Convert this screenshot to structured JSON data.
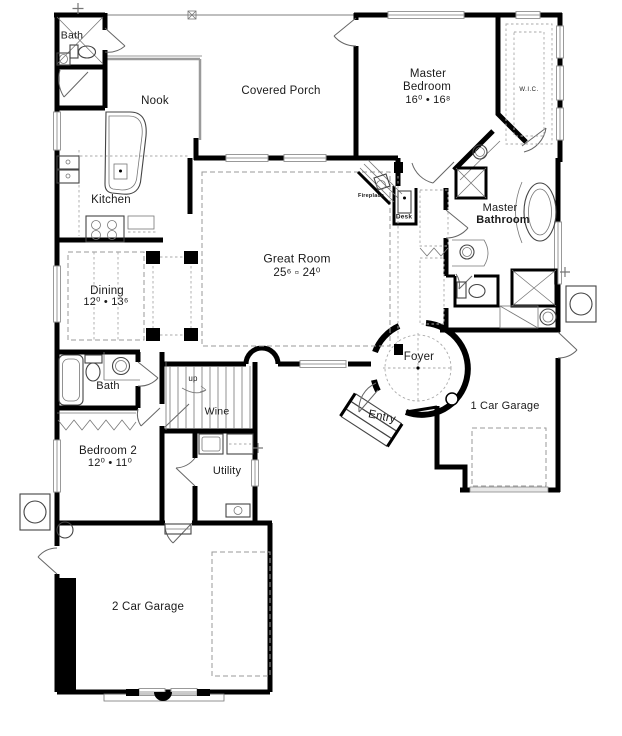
{
  "plan": {
    "rooms": {
      "bath_upper": {
        "label": "Bath"
      },
      "nook": {
        "label": "Nook"
      },
      "covered_porch": {
        "label": "Covered Porch"
      },
      "master_bedroom": {
        "line1": "Master",
        "line2": "Bedroom",
        "dims": "16⁰ •  16⁸"
      },
      "wic": {
        "label": "W.I.C."
      },
      "kitchen": {
        "label": "Kitchen"
      },
      "fireplace": {
        "label": "Fireplace"
      },
      "desk": {
        "label": "Desk"
      },
      "master_bathroom": {
        "line1": "Master",
        "line2": "Bathroom"
      },
      "great_room": {
        "label": "Great Room",
        "dims": "25⁶ ▫ 24⁰"
      },
      "dining": {
        "label": "Dining",
        "dims": "12⁰ •  13⁶"
      },
      "bath_main": {
        "label": "Bath"
      },
      "stairs": {
        "label": "up"
      },
      "wine": {
        "label": "Wine"
      },
      "foyer": {
        "label": "Foyer"
      },
      "entry": {
        "label": "Entry"
      },
      "garage_1car": {
        "label": "1 Car Garage"
      },
      "bedroom2": {
        "line1": "Bedroom 2",
        "dims": "12⁰ •  11⁰"
      },
      "utility": {
        "label": "Utility"
      },
      "garage_2car": {
        "label": "2 Car Garage"
      }
    },
    "icons": [
      "bathtub-icon",
      "toilet-icon",
      "sink-icon",
      "stove-icon",
      "kitchen-island-icon",
      "fireplace-icon",
      "desk-icon",
      "shower-icon",
      "garden-tub-icon",
      "washer-icon",
      "dryer-icon",
      "stairs-icon",
      "door-swing-icon",
      "window-icon",
      "ac-unit-icon",
      "entry-steps-icon",
      "foyer-turret-icon"
    ],
    "colors": {
      "wall": "#000000",
      "window": "#999999",
      "dashed": "#999999",
      "background": "#ffffff"
    }
  }
}
